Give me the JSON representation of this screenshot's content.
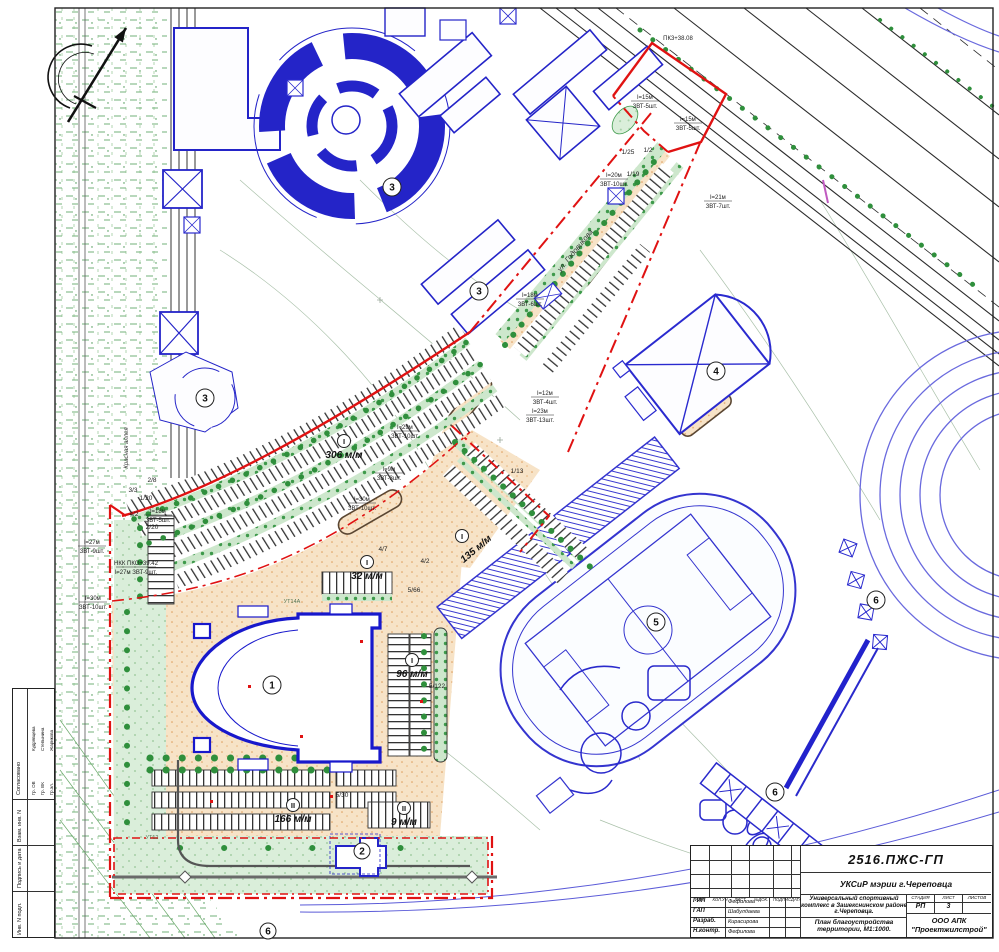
{
  "title_block": {
    "doc_number": "2516.ПЖС-ГП",
    "client": "УКСиР мэрии г.Череповца",
    "project_name": "Универсальный спортивный комплекс в Зашекснинском районе г.Череповца.",
    "sheet_title": "План благоустройства территории, М1:1000.",
    "stage_label": "СТАДИЯ",
    "sheet_label": "ЛИСТ",
    "sheets_label": "ЛИСТОВ",
    "stage": "РП",
    "sheet_number": "3",
    "company_line1": "ООО АПК",
    "company_line2": "\"Проектжилстрой\"",
    "rev_header": [
      "ИЗМ.",
      "КОЛ.УЧ",
      "ЛИСТ",
      "№ДОК.",
      "ПОДПИСЬ",
      "ДАТА"
    ],
    "roles": [
      {
        "role": "ГИП",
        "name": "Фефилова"
      },
      {
        "role": "ГАП",
        "name": "Шабулдаева"
      },
      {
        "role": "Разраб.",
        "name": "Кирасирова"
      },
      {
        "role": "Н.контр.",
        "name": "Фефилова"
      }
    ]
  },
  "side_stamp": {
    "agreed_label": "Согласовано",
    "signers": [
      {
        "group": "Гр. ОВ",
        "name": "Кудрявцева"
      },
      {
        "group": "Гр. ВК",
        "name": "Степынина"
      },
      {
        "group": "Гр.эл.",
        "name": "Жарикова"
      }
    ],
    "frame_cells": [
      "Взам. инв. N",
      "Подпись и дата",
      "Инв. N подл."
    ]
  },
  "plan": {
    "streets": [
      {
        "name": "ул. Годовикова",
        "x": 577,
        "y": 252,
        "rot": -51
      },
      {
        "name": "Красная аллея",
        "x": 128,
        "y": 448,
        "rot": -90
      }
    ],
    "building_callouts": [
      {
        "num": "1",
        "x": 272,
        "y": 685
      },
      {
        "num": "2",
        "x": 362,
        "y": 851
      },
      {
        "num": "3",
        "x": 392,
        "y": 187
      },
      {
        "num": "3",
        "x": 479,
        "y": 291
      },
      {
        "num": "3",
        "x": 205,
        "y": 398
      },
      {
        "num": "4",
        "x": 716,
        "y": 371
      },
      {
        "num": "5",
        "x": 656,
        "y": 622
      },
      {
        "num": "6",
        "x": 876,
        "y": 600
      },
      {
        "num": "6",
        "x": 775,
        "y": 792
      },
      {
        "num": "6",
        "x": 268,
        "y": 931
      }
    ],
    "parking_labels": [
      {
        "badge": "I",
        "text": "306 м/м",
        "x": 344,
        "y": 455
      },
      {
        "badge": "I",
        "text": "32 м/м",
        "x": 367,
        "y": 576
      },
      {
        "badge": "I",
        "text": "96 м/м",
        "x": 412,
        "y": 674
      },
      {
        "badge": "II",
        "text": "166 м/м",
        "x": 293,
        "y": 819
      },
      {
        "badge": "I",
        "text": "135 м/м",
        "x": 476,
        "y": 549
      },
      {
        "badge": "II",
        "text": "9 м/м",
        "x": 404,
        "y": 822
      }
    ],
    "annotations": [
      {
        "top": "ПК3+38.08",
        "bottom": "",
        "x": 678,
        "y": 40
      },
      {
        "top": "l=15м",
        "bottom": "ЗВТ-5шт.",
        "x": 645,
        "y": 100
      },
      {
        "top": "l=15м",
        "bottom": "ЗВТ-5шт.",
        "x": 688,
        "y": 122
      },
      {
        "top": "l=21м",
        "bottom": "ЗВТ-7шт.",
        "x": 718,
        "y": 200
      },
      {
        "top": "l=20м",
        "bottom": "ЗВТ-10шт.",
        "x": 614,
        "y": 178
      },
      {
        "top": "l=18м",
        "bottom": "ЗВТ-6шт.",
        "x": 530,
        "y": 298
      },
      {
        "top": "l=12м",
        "bottom": "ЗВТ-4шт.",
        "x": 545,
        "y": 396
      },
      {
        "top": "l=23м",
        "bottom": "ЗВТ-13шт.",
        "x": 540,
        "y": 414
      },
      {
        "top": "l=29м",
        "bottom": "ЗВТ-10шт.",
        "x": 405,
        "y": 430
      },
      {
        "top": "l=30м",
        "bottom": "ЗВТ-10шт.",
        "x": 362,
        "y": 502
      },
      {
        "top": "l=9м",
        "bottom": "ЗВТ-3шт.",
        "x": 389,
        "y": 472
      },
      {
        "top": "l=18м",
        "bottom": "ЗВТ-5шт.",
        "x": 158,
        "y": 514
      },
      {
        "top": "l=27м",
        "bottom": "ЗВТ-9шт.",
        "x": 92,
        "y": 545
      },
      {
        "top": "НКК ПКО+39.42",
        "bottom": "l=27м ЗВТ-9шт.",
        "x": 136,
        "y": 566
      },
      {
        "top": "l=30м",
        "bottom": "ЗВТ-10шт.",
        "x": 93,
        "y": 601
      }
    ],
    "fractions": [
      {
        "v": "1/25",
        "x": 628,
        "y": 154
      },
      {
        "v": "1/2",
        "x": 648,
        "y": 152
      },
      {
        "v": "1/19",
        "x": 633,
        "y": 176
      },
      {
        "v": "3/3",
        "x": 133,
        "y": 492
      },
      {
        "v": "1/20",
        "x": 146,
        "y": 500
      },
      {
        "v": "2/8",
        "x": 152,
        "y": 482
      },
      {
        "v": "4/2",
        "x": 134,
        "y": 516
      },
      {
        "v": "2/20",
        "x": 152,
        "y": 529
      },
      {
        "v": "1/13",
        "x": 517,
        "y": 473
      },
      {
        "v": "4/7",
        "x": 383,
        "y": 551
      },
      {
        "v": "4/2",
        "x": 425,
        "y": 563
      },
      {
        "v": "5/66",
        "x": 414,
        "y": 592
      },
      {
        "v": "5/122",
        "x": 437,
        "y": 688
      },
      {
        "v": "5/30",
        "x": 342,
        "y": 797
      }
    ],
    "utilities": [
      {
        "t": "УТ14А",
        "x": 292,
        "y": 603
      },
      {
        "t": "УТ12",
        "x": 152,
        "y": 839
      }
    ]
  },
  "colors": {
    "existing_blue": "#2424c8",
    "path_blue": "#6a6ade",
    "boundary_red": "#e01212",
    "vegetation_green": "#2f8f3c",
    "lawn_green": "#daeeda",
    "paving_tan": "#f7e3c7",
    "ink": "#222222",
    "topo_grey": "#a9c0a9"
  }
}
